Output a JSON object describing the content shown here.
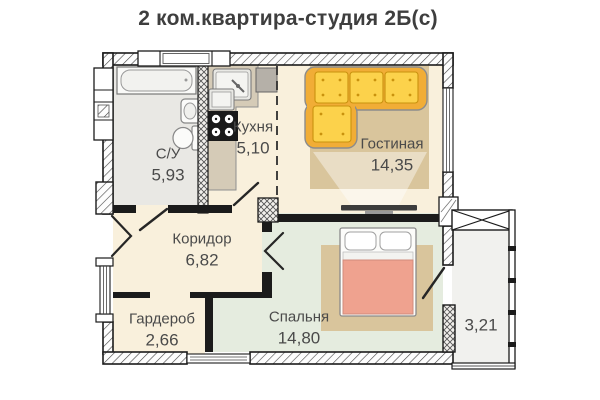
{
  "title": "2 ком.квартира-студия 2Б(с)",
  "rooms": [
    {
      "name": "С/У",
      "area": "5,93"
    },
    {
      "name": "Кухня",
      "area": "5,10"
    },
    {
      "name": "Гостиная",
      "area": "14,35"
    },
    {
      "name": "Коридор",
      "area": "6,82"
    },
    {
      "name": "Гардероб",
      "area": "2,66"
    },
    {
      "name": "Спальня",
      "area": "14,80"
    },
    {
      "name": "",
      "area": "3,21"
    }
  ],
  "colors": {
    "wall": "#1b1b1b",
    "floor_main": "#f9f0dc",
    "floor_bathroom": "#e9e8e4",
    "floor_bedroom": "#e5ecdf",
    "floor_balcony": "#f1f1ee",
    "rug": "#d9c59c",
    "sofa_frame": "#f1ad36",
    "sofa_cushion": "#fcd24b",
    "bed_blanket": "#efa28f",
    "counter": "#d5cbb7",
    "appliance_gray": "#b5b0a8",
    "stove": "#1a1a1a",
    "tv": "#3c3c3c",
    "text": "#4a4a4a"
  }
}
